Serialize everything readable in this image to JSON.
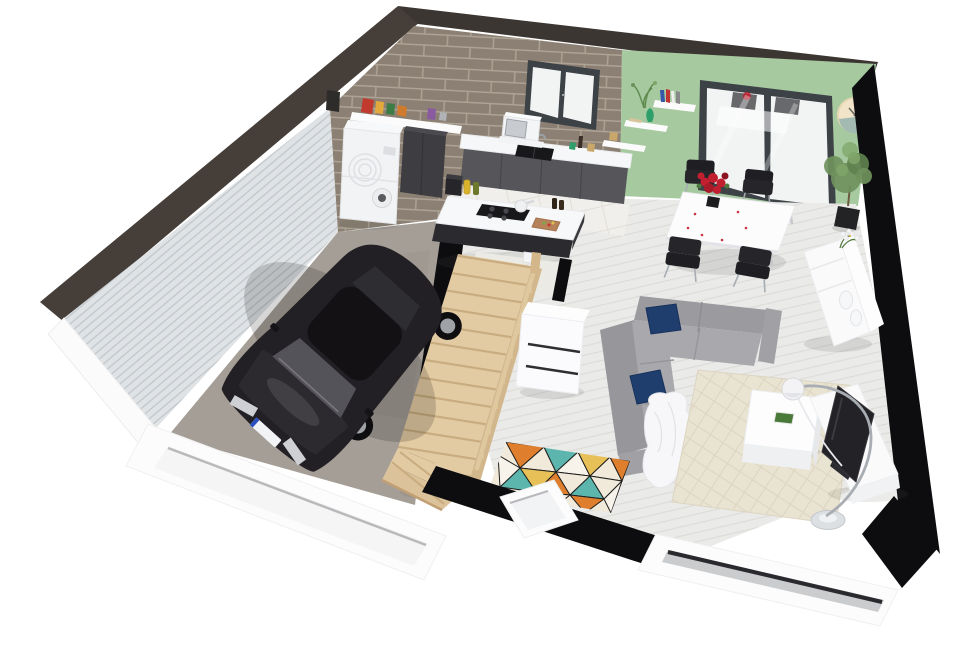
{
  "scene": {
    "type": "3d-floor-plan-render",
    "rooms": [
      "garage",
      "kitchen",
      "dining-area",
      "living-room",
      "staircase",
      "wc"
    ],
    "objects": [
      "black-car",
      "washer-dryer-stack",
      "pantry-shelf",
      "tall-cabinet",
      "kitchen-counter",
      "sink",
      "microwave",
      "kitchen-island",
      "cooktop",
      "dining-table",
      "dining-chairs",
      "flower-bouquet",
      "patio-door",
      "kitchen-window",
      "wall-clock",
      "wall-shelves",
      "potted-tree",
      "sideboard",
      "sectional-sofa",
      "navy-pillows",
      "white-throw",
      "coffee-table",
      "beige-rug",
      "geometric-rug",
      "arc-floor-lamp",
      "tv-stand",
      "tv",
      "storage-cabinet",
      "toilet",
      "wood-staircase",
      "garage-door-opening",
      "front-window-openings"
    ]
  },
  "colors": {
    "band_brown": "#453e39",
    "band_brown2": "#3b3632",
    "band_black": "#0d0d10",
    "siding_base": "#dfe3e6",
    "siding_stripe": "#c2c7cb",
    "brick_base": "#8b8073",
    "brick_mortar": "#b1a798",
    "green_wall": "#a6c9a0",
    "frame_dark": "#3d4247",
    "glass_white": "#f2f4f4",
    "clock_cream": "#f2e4c8",
    "clock_teal": "#a3bab2",
    "counter_white": "#f6f7f8",
    "cabinet_gray": "#55555a",
    "cabinet_dark": "#3e3d42",
    "washer_white": "#f2f3f5",
    "island_top": "#f7f8f9",
    "island_base": "#2b2a2e",
    "cooktop_black": "#18181b",
    "floor_plank": "#eaeae8",
    "plank_line": "#dddbd8",
    "floor_tile": "#f1efec",
    "tile_line": "#e2ded8",
    "garage_floor": "#a49e97",
    "stair_wood": "#e2caa2",
    "stair_side": "#d2b78c",
    "rail_wood": "#dfc79e",
    "tread_line": "#c8ab7e",
    "car_body": "#222024",
    "car_roof": "#131114",
    "car_glass": "#55535a",
    "wheel_dark": "#0e0e10",
    "rim_silver": "#9fa3a8",
    "sofa_gray": "#9b9b9f",
    "sofa_light": "#a9a9ad",
    "sofa_arm": "#a1a1a5",
    "pillow_navy": "#1f3e6e",
    "throw_white": "#f7f7f9",
    "rug_beige": "#e9e3d2",
    "lattice_line": "#d9d1bd",
    "table_white": "#fcfcfd",
    "chair_black": "#1f1f23",
    "chrome": "#a7adb3",
    "flower_red": "#c22030",
    "coffee_white": "#fdfdfe",
    "tv_screen": "#232327",
    "unit_white": "#fafafb",
    "plant_green": "#6f915c",
    "plant_green2": "#7fa469",
    "pot_black": "#232326",
    "rug_orange": "#df7f2e",
    "rug_teal": "#5cb6ae",
    "rug_yellow": "#e7c058",
    "rug_cream": "#f1e9d9",
    "rug_white": "#f7f3ea",
    "rug_line": "#1e1e1e",
    "wall_white": "#fcfcfd",
    "opening_shadow": "#b9b9bc",
    "toilet_white": "#f7f8f9",
    "wc_floor": "#eceae5",
    "storage_white": "#fbfbfd",
    "glass_strip": "#2a2a2e",
    "vase_green": "#2e9e6b",
    "shelf_white": "#fbfbfc"
  }
}
